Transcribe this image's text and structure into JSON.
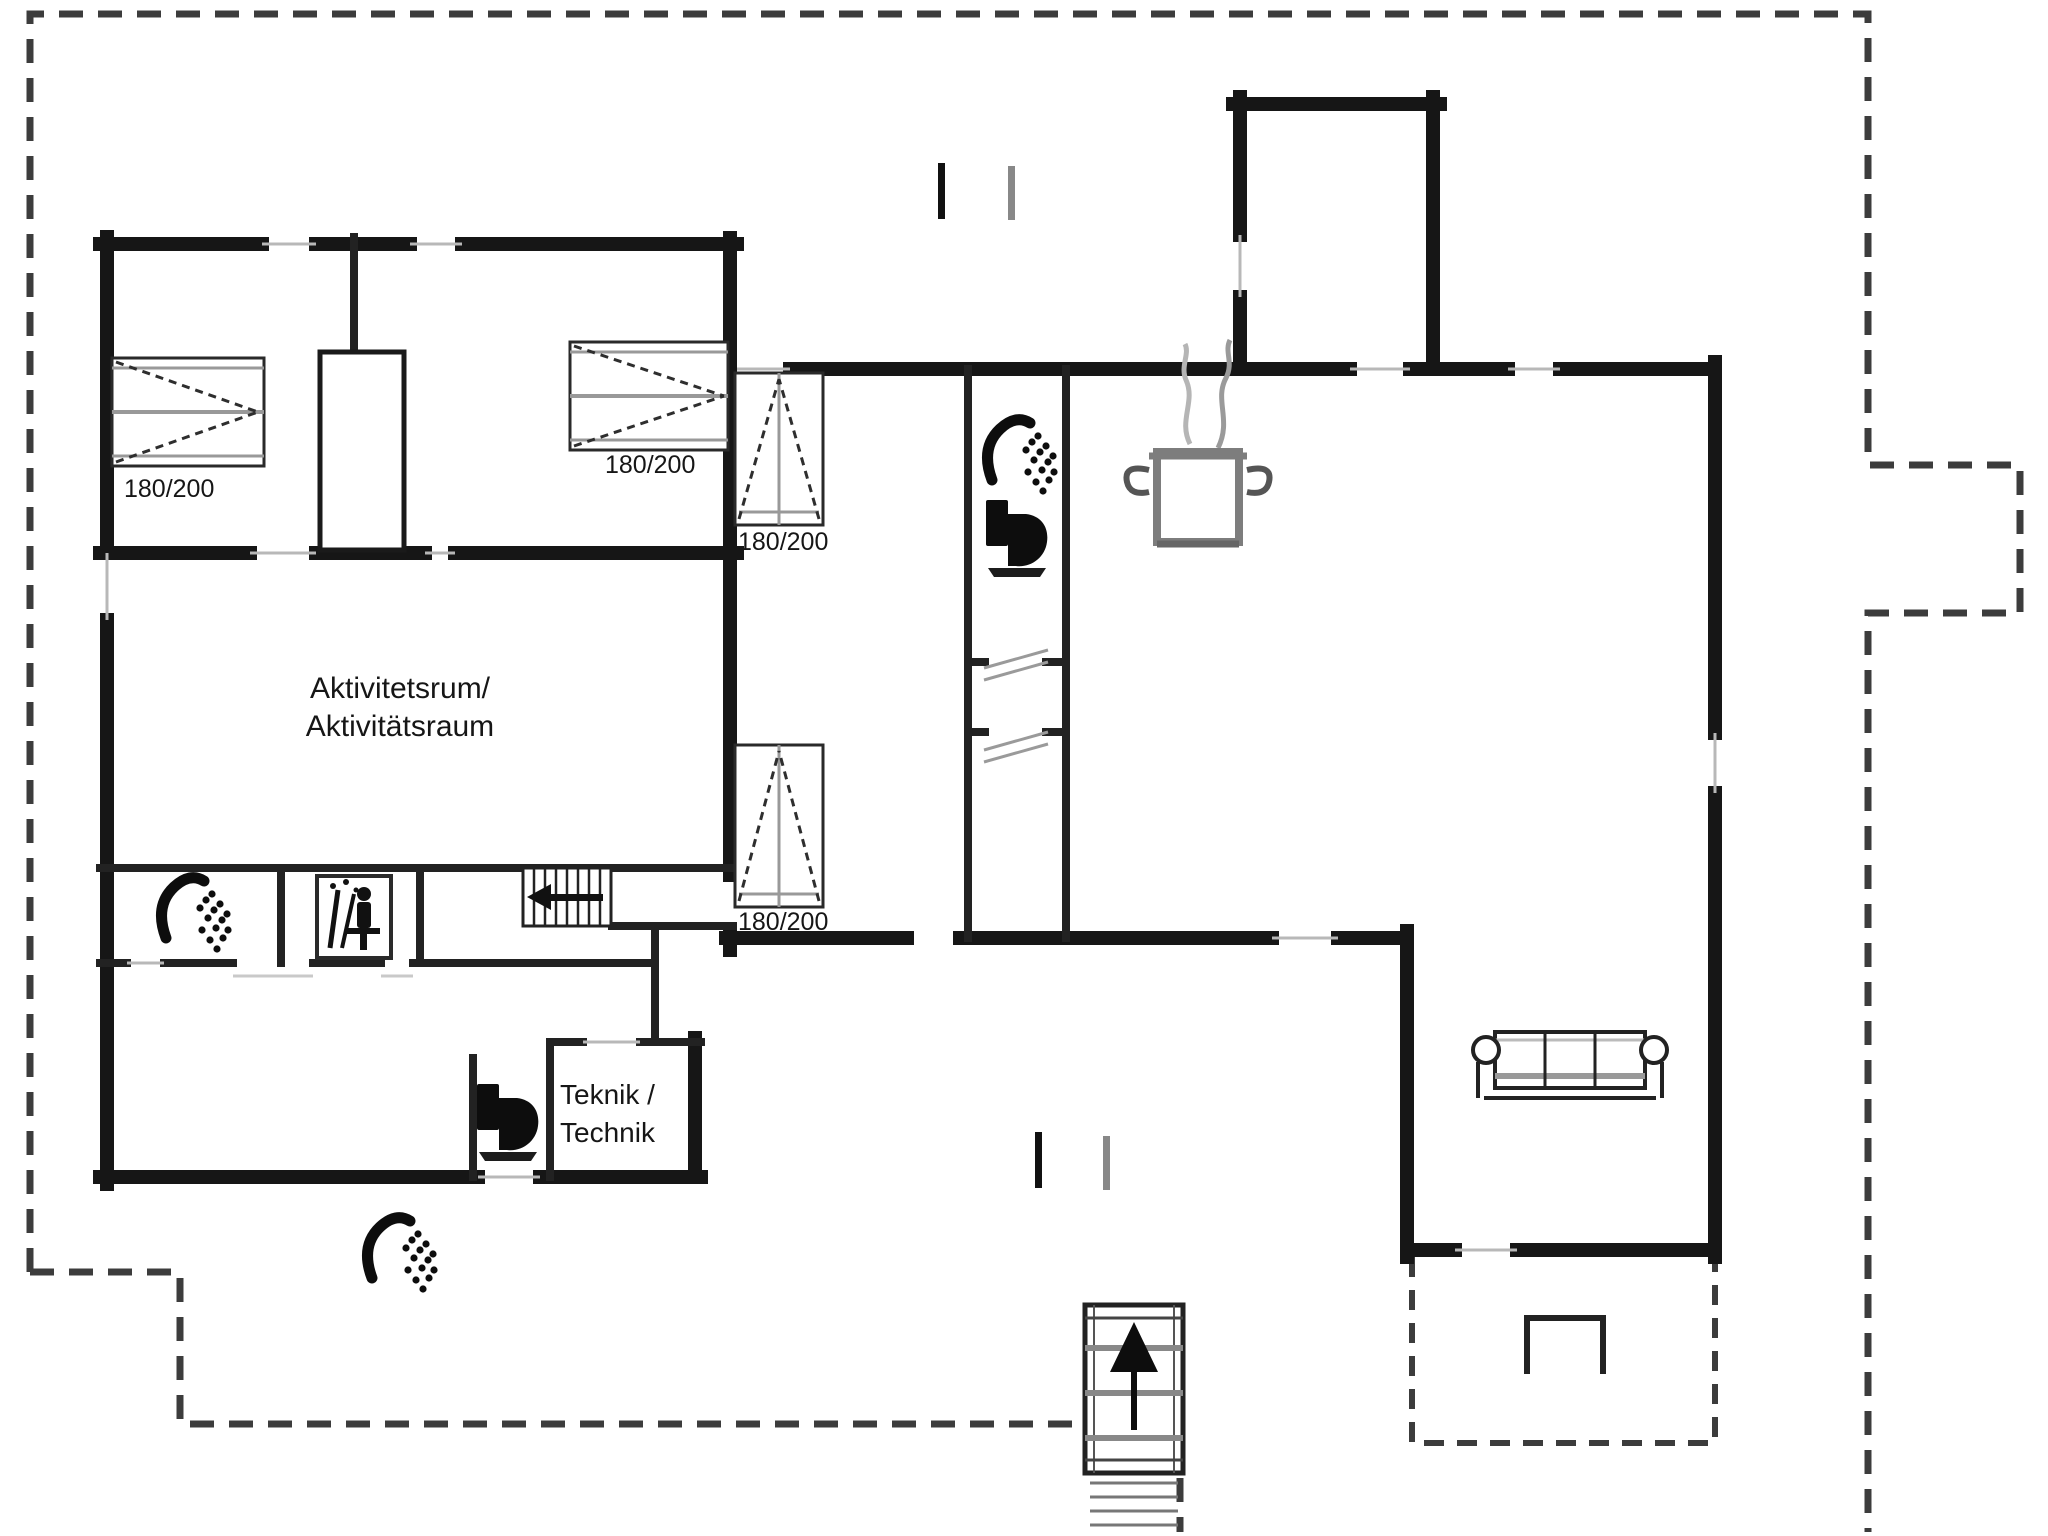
{
  "plan": {
    "type": "floor-plan",
    "background": "#ffffff",
    "colors": {
      "wall": "#161616",
      "interior_wall": "#222222",
      "site_boundary_dashed": "#3c3c3c",
      "window_sill": "#b8b8b8",
      "furniture_gray": "#999999",
      "pot_gray": "#7d7d7d",
      "icon_black": "#0d0d0d"
    },
    "rooms": {
      "activity": {
        "line1": "Aktivitetsrum/",
        "line2": "Aktivitätsraum"
      },
      "technik": {
        "line1": "Teknik /",
        "line2": "Technik"
      }
    },
    "beds": {
      "bed1": {
        "label": "180/200"
      },
      "bed2": {
        "label": "180/200"
      },
      "bed3": {
        "label": "180/200"
      },
      "bed4": {
        "label": "180/200"
      }
    },
    "icons": [
      "shower-icon (bathroom)",
      "shower-icon (shower room)",
      "shower-icon (outdoor)",
      "toilet-icon (bathroom)",
      "toilet-icon (guest wc)",
      "sauna-icon",
      "cooking-pot-icon",
      "sofa",
      "wardrobe",
      "stairs-up-arrow (entrance)",
      "stairs-left-arrow (corridor)",
      "grill-icon (terrace)",
      "section-tick-marks"
    ]
  }
}
